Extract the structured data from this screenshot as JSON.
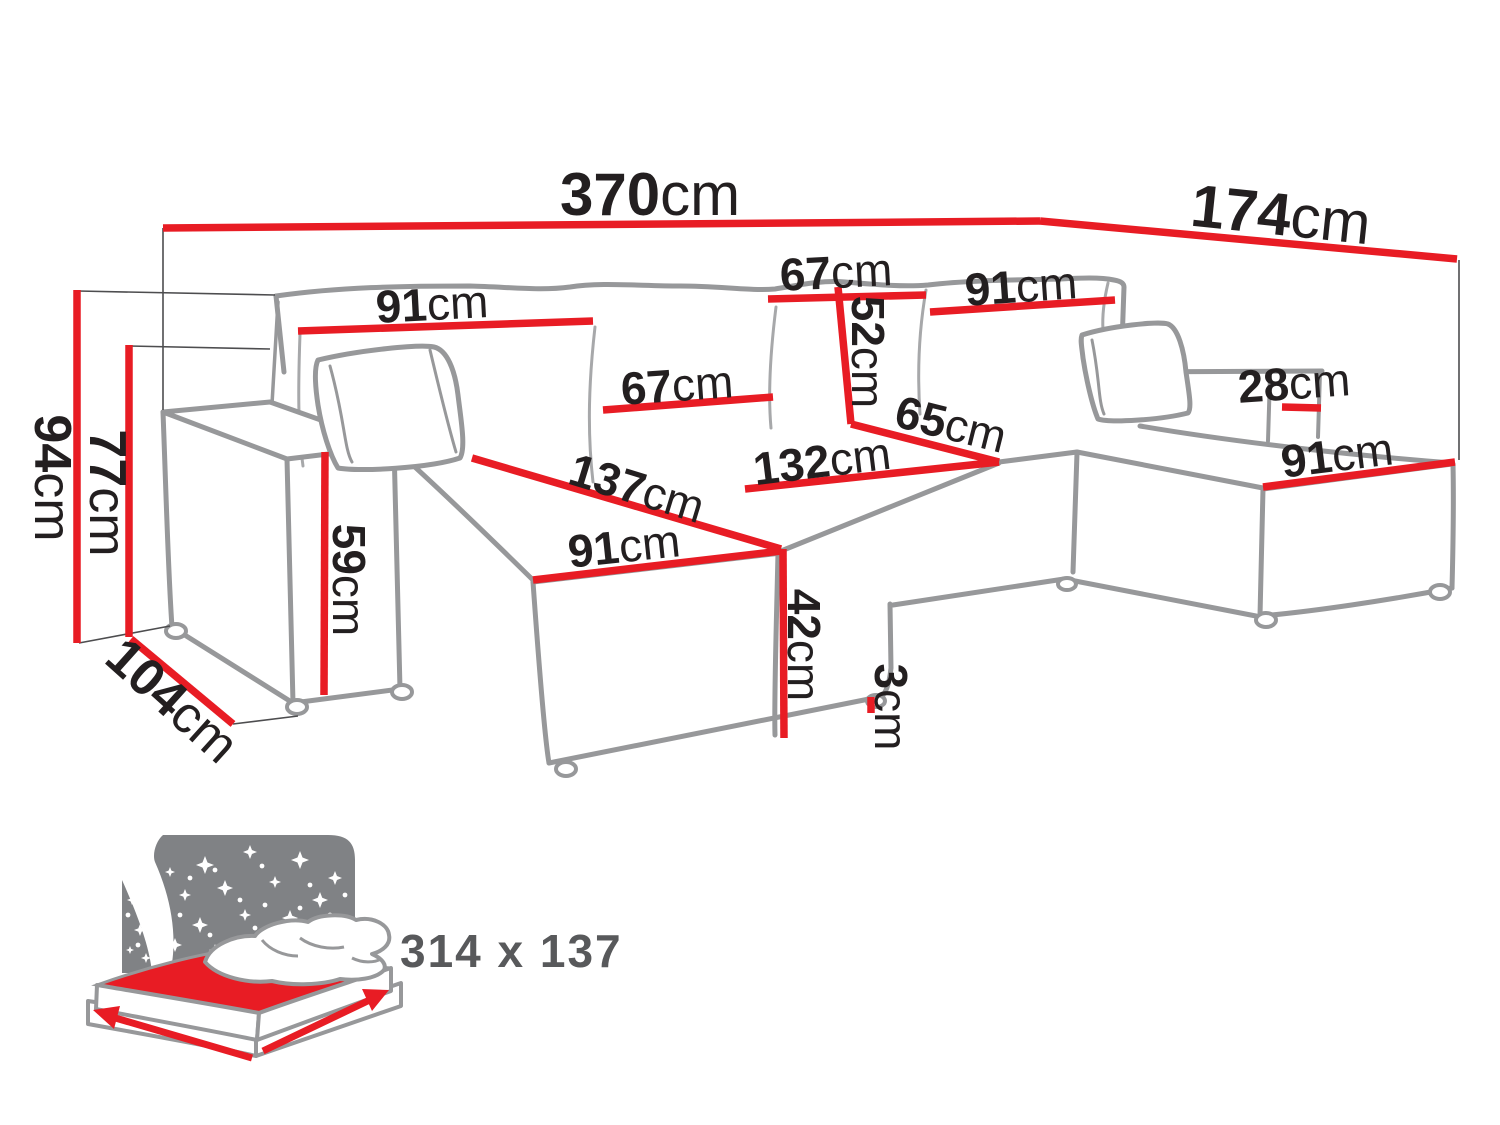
{
  "title": "U-shaped corner sofa dimension diagram",
  "colors": {
    "dimension_red": "#e81c24",
    "outline_gray": "#97989a",
    "seam_gray": "#a7a8aa",
    "label_black": "#231f20",
    "extension_gray": "#4d4d4f",
    "icon_panel_gray": "#808285",
    "icon_text_gray": "#58595b"
  },
  "dimension_labels": [
    {
      "id": "width-total",
      "text": "370cm",
      "x": 650,
      "y": 194,
      "rot": 0,
      "size": 60
    },
    {
      "id": "depth-right-total",
      "text": "174cm",
      "x": 1281,
      "y": 214,
      "rot": 6,
      "size": 60
    },
    {
      "id": "back-cushion-left",
      "text": "91cm",
      "x": 432,
      "y": 304,
      "rot": -3,
      "size": 46
    },
    {
      "id": "back-cushion-mid-top",
      "text": "67cm",
      "x": 836,
      "y": 272,
      "rot": -3,
      "size": 46
    },
    {
      "id": "back-cushion-right",
      "text": "91cm",
      "x": 1021,
      "y": 286,
      "rot": -4,
      "size": 46
    },
    {
      "id": "back-cushion-height",
      "text": "52cm",
      "x": 868,
      "y": 352,
      "rot": 90,
      "size": 46
    },
    {
      "id": "back-cushion-mid",
      "text": "67cm",
      "x": 677,
      "y": 385,
      "rot": -4,
      "size": 46
    },
    {
      "id": "seat-depth-right",
      "text": "65cm",
      "x": 951,
      "y": 424,
      "rot": 14,
      "size": 46
    },
    {
      "id": "seat-width-center",
      "text": "132cm",
      "x": 822,
      "y": 461,
      "rot": -7,
      "size": 46
    },
    {
      "id": "armrest-width-right",
      "text": "28cm",
      "x": 1294,
      "y": 383,
      "rot": -4,
      "size": 46
    },
    {
      "id": "chaise-right-length",
      "text": "91cm",
      "x": 1337,
      "y": 455,
      "rot": -7,
      "size": 46
    },
    {
      "id": "chaise-left-length",
      "text": "137cm",
      "x": 637,
      "y": 488,
      "rot": 17,
      "size": 46
    },
    {
      "id": "chaise-left-width",
      "text": "91cm",
      "x": 624,
      "y": 546,
      "rot": -6,
      "size": 46
    },
    {
      "id": "height-total",
      "text": "94cm",
      "x": 52,
      "y": 478,
      "rot": 90,
      "size": 52
    },
    {
      "id": "height-backrest",
      "text": "77cm",
      "x": 107,
      "y": 493,
      "rot": 90,
      "size": 52
    },
    {
      "id": "depth-armrest",
      "text": "104cm",
      "x": 172,
      "y": 701,
      "rot": 42,
      "size": 52
    },
    {
      "id": "armrest-height",
      "text": "59cm",
      "x": 349,
      "y": 580,
      "rot": 90,
      "size": 46
    },
    {
      "id": "seat-height",
      "text": "42cm",
      "x": 804,
      "y": 645,
      "rot": 90,
      "size": 46
    },
    {
      "id": "leg-height",
      "text": "3cm",
      "x": 891,
      "y": 707,
      "rot": 90,
      "size": 46
    }
  ],
  "dimension_lines": [
    {
      "id": "width-total",
      "x1": 163,
      "y1": 228,
      "x2": 1040,
      "y2": 221
    },
    {
      "id": "depth-right-total",
      "x1": 1040,
      "y1": 221,
      "x2": 1457,
      "y2": 259
    },
    {
      "id": "back-cushion-left",
      "x1": 298,
      "y1": 331,
      "x2": 593,
      "y2": 321
    },
    {
      "id": "back-cushion-mid-top",
      "x1": 768,
      "y1": 299,
      "x2": 926,
      "y2": 295
    },
    {
      "id": "back-cushion-right",
      "x1": 930,
      "y1": 312,
      "x2": 1115,
      "y2": 300
    },
    {
      "id": "back-cushion-height",
      "x1": 838,
      "y1": 287,
      "x2": 851,
      "y2": 424
    },
    {
      "id": "back-cushion-mid",
      "x1": 603,
      "y1": 410,
      "x2": 773,
      "y2": 397
    },
    {
      "id": "seat-depth-right",
      "x1": 851,
      "y1": 424,
      "x2": 999,
      "y2": 462
    },
    {
      "id": "seat-width-center",
      "x1": 745,
      "y1": 489,
      "x2": 999,
      "y2": 462
    },
    {
      "id": "armrest-width-right",
      "x1": 1282,
      "y1": 407,
      "x2": 1321,
      "y2": 408
    },
    {
      "id": "chaise-right-length",
      "x1": 1263,
      "y1": 487,
      "x2": 1455,
      "y2": 462
    },
    {
      "id": "chaise-left-length",
      "x1": 472,
      "y1": 458,
      "x2": 781,
      "y2": 549
    },
    {
      "id": "chaise-left-width",
      "x1": 533,
      "y1": 580,
      "x2": 781,
      "y2": 551
    },
    {
      "id": "height-total",
      "x1": 77,
      "y1": 290,
      "x2": 77,
      "y2": 643
    },
    {
      "id": "height-backrest",
      "x1": 129,
      "y1": 345,
      "x2": 129,
      "y2": 637
    },
    {
      "id": "depth-armrest",
      "x1": 131,
      "y1": 639,
      "x2": 233,
      "y2": 724
    },
    {
      "id": "armrest-height",
      "x1": 325,
      "y1": 452,
      "x2": 324,
      "y2": 695
    },
    {
      "id": "seat-height",
      "x1": 783,
      "y1": 549,
      "x2": 784,
      "y2": 738
    },
    {
      "id": "leg-height",
      "x1": 871,
      "y1": 697,
      "x2": 871,
      "y2": 713
    }
  ],
  "extension_lines": [
    {
      "x1": 163,
      "y1": 228,
      "x2": 163,
      "y2": 410
    },
    {
      "x1": 78,
      "y1": 291,
      "x2": 275,
      "y2": 295
    },
    {
      "x1": 129,
      "y1": 346,
      "x2": 270,
      "y2": 349
    },
    {
      "x1": 79,
      "y1": 643,
      "x2": 170,
      "y2": 626
    },
    {
      "x1": 233,
      "y1": 724,
      "x2": 298,
      "y2": 716
    },
    {
      "x1": 1459,
      "y1": 260,
      "x2": 1459,
      "y2": 460
    }
  ],
  "sleep_icon": {
    "label": "314 x 137"
  }
}
